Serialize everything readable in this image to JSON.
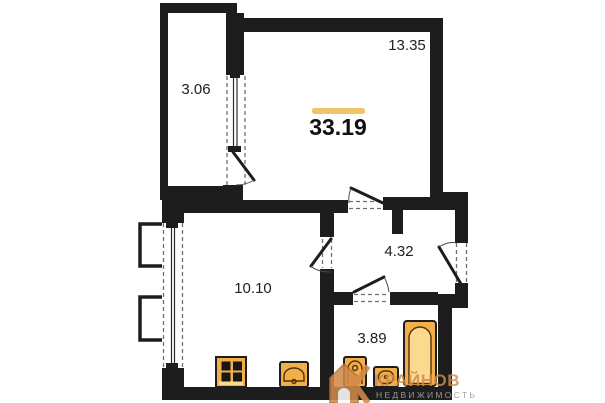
{
  "page": {
    "type": "apartment-floor-plan"
  },
  "colors": {
    "wall": "#1d1d1d",
    "accent": "#efc368",
    "fixture": "#f3ae49",
    "fixture_light": "#fbd98e",
    "logo_orange": "#d08a4b",
    "logo_gray": "#9e9e9e",
    "bg": "#ffffff"
  },
  "plan": {
    "total_area": "33.19",
    "rooms": {
      "living": {
        "area": "13.35"
      },
      "balcony": {
        "area": "3.06"
      },
      "kitchen": {
        "area": "10.10"
      },
      "hallway": {
        "area": "4.32"
      },
      "bathroom": {
        "area": "3.89"
      }
    },
    "fixtures": [
      "stove-icon",
      "kitchen-sink-icon",
      "bathroom-sink-icon",
      "toilet-icon",
      "bathtub-icon"
    ],
    "openings": [
      "balcony-door",
      "living-hall-door",
      "kitchen-hall-door",
      "bathroom-door",
      "entrance-door"
    ],
    "windows": [
      "kitchen-window",
      "balcony-window"
    ]
  },
  "watermark": {
    "brand": "КРАЙНОВ",
    "tagline": "НЕДВИЖИМОСТЬ"
  }
}
